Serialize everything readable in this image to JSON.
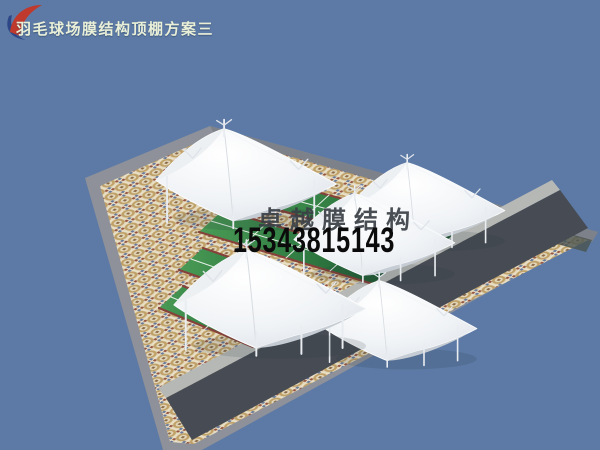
{
  "title": {
    "text": "羽毛球场膜结构顶棚方案三",
    "color": "#eaf0d8"
  },
  "watermark": {
    "company": "卓越膜结构",
    "phone": "15343815143",
    "company_color": "#3a4046",
    "phone_color": "#0b0b0b",
    "logo_red": "#bf392d",
    "logo_blue": "#2c4687"
  },
  "scene": {
    "counts": {
      "canopies": 5,
      "courts": 4
    },
    "colors": {
      "sky": "#5c7aa5",
      "rim_gray": "#8e9199",
      "rim_dark": "#7d8189",
      "apron_dark": "#474c54",
      "walk_light": "#b6b8b6",
      "dark_strip": "#4a5450",
      "mosaic_base": "#e3d8bc",
      "mosaic_ring": "#bfa066",
      "court_green": "#45964f",
      "court_green_shadow": "#1d5130",
      "court_line": "#ffffff",
      "edging_red": "#86423a",
      "membrane": "#f4f6f8",
      "membrane_shade": "#c6ccd3",
      "mast": "#e9edf1"
    }
  }
}
